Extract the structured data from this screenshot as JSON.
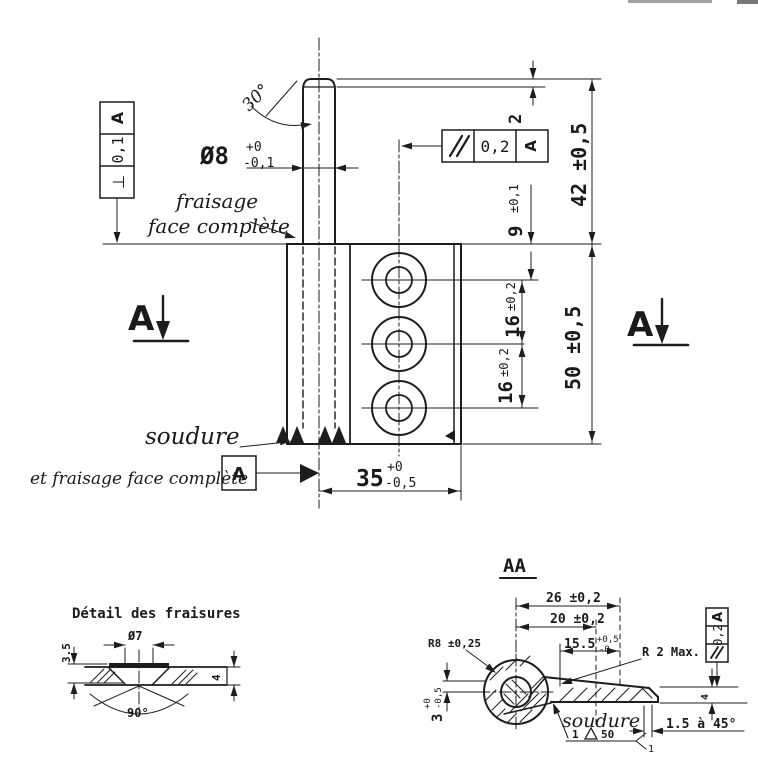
{
  "drawing": {
    "paper_color": "#ffffff",
    "ink_color": "#1d1d1d"
  },
  "main_view": {
    "fcf_perpendicularity": {
      "symbol": "⊥",
      "tolerance": "0,1",
      "datum": "A"
    },
    "fcf_parallelism": {
      "tolerance": "0,2",
      "datum": "A"
    },
    "angle_label": "30°",
    "pin_diameter": {
      "value": "Ø8",
      "tol_up": "+0",
      "tol_dn": "-0,1"
    },
    "note_fraisage_line1": "fraisage",
    "note_fraisage_line2": "face complète",
    "dim_2": "2",
    "dim_42": "42 ±0,5",
    "dim_9": {
      "value": "9",
      "tol": "±0,1"
    },
    "dim_16a": {
      "value": "16",
      "tol": "±0,2"
    },
    "dim_16b": {
      "value": "16",
      "tol": "±0,2"
    },
    "dim_50": "50 ±0,5",
    "dim_35": {
      "value": "35",
      "tol_up": "+0",
      "tol_dn": "-0,5"
    },
    "note_soudure": "soudure",
    "note_fraisage_complete": "et fraisage face complète",
    "datum_label": "A",
    "section_marker_left": "A",
    "section_marker_right": "A"
  },
  "detail_view": {
    "title": "Détail des fraisures",
    "dim_dia7": "Ø7",
    "dim_depth": "3.5",
    "dim_thickness": "4",
    "dim_angle": "90°"
  },
  "section_aa": {
    "title": "AA",
    "dim_26": "26 ±0,2",
    "dim_20": "20 ±0,2",
    "dim_155": {
      "value": "15.5",
      "tol_up": "+0,5",
      "tol_dn": "-0"
    },
    "dim_r8": "R8 ±0,25",
    "dim_r2": "R 2 Max.",
    "dim_3": {
      "value": "3",
      "tol_up": "+0",
      "tol_dn": "-0,5"
    },
    "fcf_parallelism": {
      "tolerance": "0,2",
      "datum": "A"
    },
    "dim_4": "4",
    "dim_chamfer": "1.5 à 45°",
    "note_soudure": "soudure",
    "weld_symbol": {
      "size": "1",
      "length": "50",
      "tail": "1"
    }
  }
}
